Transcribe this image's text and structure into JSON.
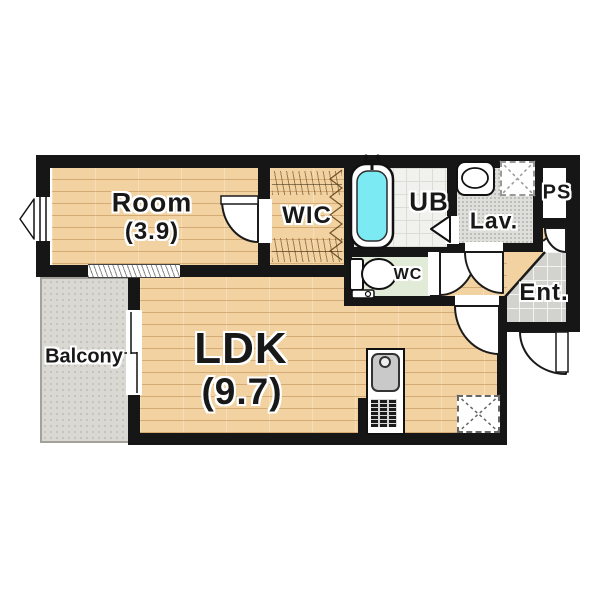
{
  "floorplan": {
    "type": "apartment-floor-plan",
    "rooms": [
      {
        "name": "Room",
        "area": "(3.9)",
        "floor": "wood"
      },
      {
        "name": "WIC",
        "floor": "wood-closet"
      },
      {
        "name": "UB",
        "floor": "tile"
      },
      {
        "name": "Lav.",
        "floor": "vinyl"
      },
      {
        "name": "PS",
        "floor": "none"
      },
      {
        "name": "WC",
        "floor": "vinyl-green"
      },
      {
        "name": "Ent.",
        "floor": "stone-tile"
      },
      {
        "name": "LDK",
        "area": "(9.7)",
        "floor": "wood"
      },
      {
        "name": "Balcony",
        "floor": "concrete"
      }
    ],
    "fixtures": [
      "bathtub",
      "faucet",
      "washbasin",
      "washing-machine-space",
      "toilet",
      "kitchen-sink",
      "gas-stove",
      "refrigerator-space"
    ],
    "colors": {
      "wall": "#161616",
      "wood_floor": "#f1d2a0",
      "bath_water": "#7ceaf2",
      "wc_floor": "#e2ead8",
      "lav_floor": "#dededb",
      "ent_tile": "#d2d2cf",
      "balcony": "#d9d8d3"
    }
  }
}
